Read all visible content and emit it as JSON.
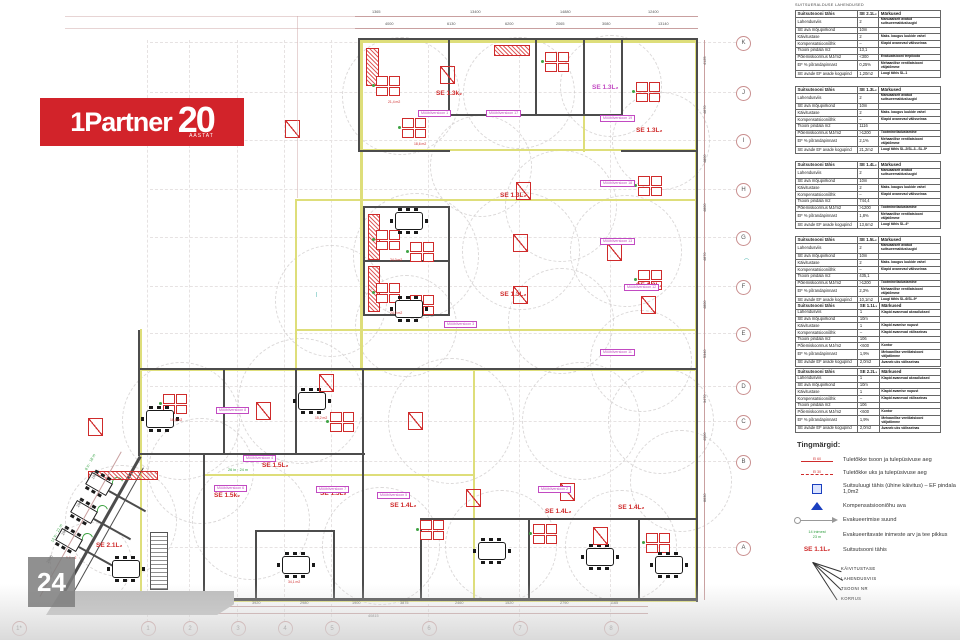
{
  "logo": {
    "brand": "1Partner",
    "twenty": "20",
    "sub": "AASTAT",
    "bg": "#d2232a"
  },
  "watermark": "24",
  "colors": {
    "accent_red": "#d2232a",
    "cad_red": "#cf2b2b",
    "magenta": "#c24ac2",
    "zone_yellow": "#dede7a",
    "wall": "#4c4c4c",
    "green": "#2e9e3e",
    "blue": "#1a3fbf"
  },
  "panel": {
    "title": "SUITSUERALDUSE LAHENDUSED",
    "row_labels": [
      "Suitsutsooni tähis",
      "Lahendusviis",
      "SE ava mõjupiirkond",
      "Käivitustase",
      "Kompensatsiooniõhk",
      "Tsooni pindala m2",
      "Põlemiskoormus MJ/m2",
      "EF % põrandapinnast",
      "SE avade EF avade kogupind"
    ],
    "remarks_header": "Märkused",
    "tables": [
      {
        "y": 10,
        "zone": "SE 2.1L₂",
        "values": [
          "2",
          "10m",
          "2",
          "–",
          "13,1",
          "<300",
          "0,25%",
          "1,20m2"
        ],
        "remarks": [
          "Manuaalselt avatud suitsueemaldusluugid",
          "",
          "Maks. kaugus luukide vahel",
          "Klapid avanevad välisseinas",
          "",
          "Evakuatsiooni trepikoda",
          "Mehaanilise ventilatsiooni väljatõmme",
          "Luugi tähis SL-1"
        ]
      },
      {
        "y": 86,
        "zone": "SE 1.3L₂",
        "values": [
          "2",
          "10m",
          "2",
          "–",
          "1116",
          ">1200",
          "2,1%",
          "21,2m2"
        ],
        "remarks": [
          "Manuaalselt avatud suitsueemaldusluugid",
          "",
          "Maks. kaugus luukide vahel",
          "Klapid avanevad välisseinas",
          "",
          "Tootmine/ladustamine",
          "Mehaanilise ventilatsiooni väljatõmme",
          "Luugi tähis SL-2/SL-3...SL-5*"
        ]
      },
      {
        "y": 161,
        "zone": "SE 1.4L₂",
        "values": [
          "2",
          "10m",
          "2",
          "–",
          "744,4",
          ">1200",
          "1,8%",
          "13,6m2"
        ],
        "remarks": [
          "Manuaalselt avatud suitsueemaldusluugid",
          "",
          "Maks. kaugus luukide vahel",
          "Klapid avanevad välisseinas",
          "",
          "Tootmine/ladustamine",
          "Mehaanilise ventilatsiooni väljatõmme",
          "Luugi tähis SL-4*"
        ]
      },
      {
        "y": 236,
        "zone": "SE 1.5L₂",
        "values": [
          "2",
          "10m",
          "2",
          "–",
          "435,1",
          ">1200",
          "2,3%",
          "10,1m2"
        ],
        "remarks": [
          "Manuaalselt avatud suitsueemaldusluugid",
          "",
          "Maks. kaugus luukide vahel",
          "Klapid avanevad välisseinas",
          "",
          "Tootmine/ladustamine",
          "Mehaanilise ventilatsiooni väljatõmme",
          "Luugi tähis SL-6/SL-9*"
        ]
      },
      {
        "y": 302,
        "zone": "SE 1.1L₁",
        "values": [
          "1",
          "10m",
          "1",
          "–",
          "106",
          "<600",
          "1,9%",
          "2,0m2"
        ],
        "remarks": [
          "Klapid avanevad aknad/uksed",
          "",
          "Klapid avamise nupust",
          "Klapid avanevad välisseinas",
          "",
          "Kontor",
          "Mehaanilise ventilatsiooni väljatõmme",
          "Avaneb uks välisseinas"
        ]
      },
      {
        "y": 368,
        "zone": "SE 2.2L₁",
        "values": [
          "1",
          "10m",
          "1",
          "–",
          "106",
          "<600",
          "1,9%",
          "2,0m2"
        ],
        "remarks": [
          "Klapid avanevad aknad/uksed",
          "",
          "Klapid avamise nupust",
          "Klapid avanevad välisseinas",
          "",
          "Kontor",
          "Mehaanilise ventilatsiooni väljatõmme",
          "Avaneb uks välisseinas"
        ]
      }
    ]
  },
  "legend": {
    "title": "Tingmärgid:",
    "items": [
      {
        "sym": "line-solid",
        "sym_text": "EI 60",
        "label": "Tuletõkke tsoon ja tulepüsivuse aeg"
      },
      {
        "sym": "line-dashed",
        "sym_text": "EI 30",
        "label": "Tuletõkke uks ja tulepüsivuse aeg"
      },
      {
        "sym": "blue-square",
        "label": "Suitsuluugi tähis (ühine käivitus) – EF pindala 1,0m2"
      },
      {
        "sym": "blue-triangle",
        "label": "Kompensatsiooniõhu ava"
      },
      {
        "sym": "arrow",
        "label": "Evakueerimise suund"
      },
      {
        "sym": "green-text",
        "sym_text": "14 inimest\n23 m",
        "label": "Evakueeritavate inimeste arv ja tee pikkus"
      },
      {
        "sym": "se-label",
        "sym_text": "SE 1.1L₂",
        "label": "Suitsutsooni tähis"
      }
    ],
    "callouts": [
      "KÄIVITUSTASE",
      "LAHENDUSVIIS",
      "TSOONI NR",
      "KORRUS"
    ]
  },
  "grid": {
    "bottom_bubbles": [
      [
        "1*",
        18
      ],
      [
        "1",
        147
      ],
      [
        "2",
        189
      ],
      [
        "3",
        237
      ],
      [
        "4",
        284
      ],
      [
        "5",
        331
      ],
      [
        "6",
        428
      ],
      [
        "7",
        519
      ],
      [
        "8",
        610
      ]
    ],
    "right_bubbles": [
      [
        "K",
        42
      ],
      [
        "J",
        92
      ],
      [
        "I",
        140
      ],
      [
        "H",
        189
      ],
      [
        "G",
        237
      ],
      [
        "F",
        286
      ],
      [
        "E",
        333
      ],
      [
        "D",
        386
      ],
      [
        "C",
        421
      ],
      [
        "B",
        461
      ],
      [
        "A",
        547
      ]
    ],
    "v_lines": [
      147,
      189,
      237,
      284,
      331,
      428,
      519,
      610
    ],
    "h_lines": [
      42,
      92,
      140,
      189,
      237,
      286,
      333,
      386,
      421,
      461,
      547
    ]
  },
  "plan": {
    "circles": [
      [
        400,
        95,
        58
      ],
      [
        518,
        92,
        55
      ],
      [
        610,
        85,
        50
      ],
      [
        660,
        140,
        48
      ],
      [
        415,
        255,
        62
      ],
      [
        520,
        250,
        58
      ],
      [
        625,
        250,
        55
      ],
      [
        405,
        325,
        50
      ],
      [
        560,
        320,
        52
      ],
      [
        480,
        165,
        50
      ],
      [
        560,
        205,
        55
      ],
      [
        330,
        300,
        55
      ],
      [
        300,
        400,
        62
      ],
      [
        180,
        420,
        58
      ],
      [
        450,
        420,
        62
      ],
      [
        580,
        420,
        58
      ],
      [
        660,
        420,
        52
      ],
      [
        250,
        520,
        58
      ],
      [
        380,
        545,
        58
      ],
      [
        500,
        545,
        55
      ],
      [
        620,
        545,
        55
      ],
      [
        120,
        520,
        55
      ],
      [
        90,
        562,
        40
      ],
      [
        680,
        480,
        50
      ],
      [
        640,
        360,
        50
      ],
      [
        200,
        470,
        52
      ]
    ],
    "zones": [
      [
        360,
        40,
        337,
        3
      ],
      [
        360,
        149,
        337,
        2
      ],
      [
        295,
        199,
        402,
        2
      ],
      [
        295,
        329,
        402,
        2
      ],
      [
        140,
        369,
        557,
        2
      ],
      [
        205,
        474,
        270,
        2
      ],
      [
        140,
        599,
        557,
        3
      ],
      [
        360,
        40,
        3,
        331
      ],
      [
        695,
        40,
        3,
        562
      ],
      [
        295,
        199,
        2,
        172
      ],
      [
        140,
        329,
        2,
        272
      ],
      [
        473,
        369,
        2,
        232
      ],
      [
        583,
        40,
        2,
        112
      ]
    ],
    "walls": [
      [
        358,
        38,
        340,
        2
      ],
      [
        358,
        38,
        2,
        114
      ],
      [
        448,
        38,
        2,
        78
      ],
      [
        535,
        38,
        2,
        78
      ],
      [
        583,
        38,
        2,
        78
      ],
      [
        621,
        38,
        2,
        78
      ],
      [
        448,
        114,
        175,
        2
      ],
      [
        358,
        150,
        92,
        2
      ],
      [
        621,
        150,
        77,
        2
      ],
      [
        696,
        38,
        2,
        564
      ],
      [
        363,
        206,
        87,
        2
      ],
      [
        363,
        206,
        2,
        110
      ],
      [
        448,
        206,
        2,
        110
      ],
      [
        363,
        260,
        87,
        2
      ],
      [
        363,
        314,
        87,
        2
      ],
      [
        138,
        368,
        560,
        2
      ],
      [
        362,
        370,
        2,
        230
      ],
      [
        138,
        330,
        2,
        126
      ],
      [
        138,
        453,
        227,
        2
      ],
      [
        223,
        368,
        2,
        87
      ],
      [
        295,
        368,
        2,
        87
      ],
      [
        203,
        454,
        2,
        146
      ],
      [
        60,
        598,
        638,
        3
      ],
      [
        255,
        530,
        80,
        2
      ],
      [
        255,
        530,
        2,
        70
      ],
      [
        333,
        530,
        2,
        70
      ],
      [
        420,
        518,
        110,
        2
      ],
      [
        420,
        518,
        2,
        82
      ],
      [
        528,
        518,
        2,
        82
      ],
      [
        530,
        518,
        110,
        2
      ],
      [
        638,
        518,
        60,
        2
      ],
      [
        638,
        518,
        2,
        82
      ]
    ],
    "diag_walls": [
      [
        60,
        598,
        164,
        3,
        -60.7
      ],
      [
        70,
        598,
        150,
        1,
        -60.7
      ]
    ],
    "diag_dividers": [
      [
        79,
        546,
        42,
        1.5,
        29
      ],
      [
        94,
        518,
        42,
        1.5,
        29
      ],
      [
        109,
        490,
        42,
        1.5,
        29
      ]
    ],
    "door_arcs": [
      [
        82,
        533,
        -60
      ],
      [
        97,
        505,
        -60
      ],
      [
        112,
        477,
        -60
      ]
    ],
    "hatches": [
      [
        366,
        48,
        11,
        36
      ],
      [
        494,
        45,
        34,
        9
      ],
      [
        368,
        214,
        10,
        44
      ],
      [
        368,
        266,
        10,
        44
      ],
      [
        88,
        471,
        68,
        7
      ]
    ],
    "stairs": [
      [
        150,
        532,
        16,
        56
      ]
    ],
    "quads": [
      [
        376,
        76
      ],
      [
        402,
        118
      ],
      [
        545,
        52
      ],
      [
        636,
        82
      ],
      [
        376,
        230
      ],
      [
        410,
        242
      ],
      [
        376,
        283
      ],
      [
        410,
        295
      ],
      [
        163,
        394
      ],
      [
        330,
        412
      ],
      [
        420,
        520
      ],
      [
        533,
        524
      ],
      [
        646,
        533
      ],
      [
        638,
        176
      ],
      [
        638,
        270
      ]
    ],
    "confs": [
      [
        395,
        212
      ],
      [
        395,
        300
      ],
      [
        146,
        410
      ],
      [
        298,
        392
      ],
      [
        282,
        556
      ],
      [
        478,
        542
      ],
      [
        586,
        548
      ],
      [
        112,
        560
      ],
      [
        655,
        556
      ]
    ],
    "sixes": [
      [
        62,
        528
      ],
      [
        77,
        500
      ],
      [
        92,
        472
      ]
    ],
    "efs": [
      [
        285,
        120
      ],
      [
        516,
        182
      ],
      [
        513,
        234
      ],
      [
        513,
        286
      ],
      [
        88,
        418
      ],
      [
        256,
        402
      ],
      [
        408,
        412
      ],
      [
        319,
        374
      ],
      [
        560,
        483
      ],
      [
        466,
        489
      ],
      [
        641,
        296
      ],
      [
        607,
        243
      ],
      [
        593,
        527
      ],
      [
        440,
        66
      ]
    ],
    "se_labels": [
      {
        "t": "SE 1.3k₂",
        "x": 436,
        "y": 90,
        "c": "red"
      },
      {
        "t": "SE 1.3L₂",
        "x": 592,
        "y": 84,
        "c": "mag"
      },
      {
        "t": "SE 1.3L₂",
        "x": 636,
        "y": 127,
        "c": "red"
      },
      {
        "t": "SE 1.3L₂",
        "x": 500,
        "y": 192,
        "c": "red"
      },
      {
        "t": "SE 1.3L₂",
        "x": 500,
        "y": 291,
        "c": "red"
      },
      {
        "t": "SE 1.3L₂",
        "x": 636,
        "y": 282,
        "c": "red"
      },
      {
        "t": "SE 1.5L₂",
        "x": 262,
        "y": 462,
        "c": "red"
      },
      {
        "t": "SE 1.5k₂",
        "x": 214,
        "y": 492,
        "c": "red"
      },
      {
        "t": "SE 1.5L₂",
        "x": 320,
        "y": 490,
        "c": "red"
      },
      {
        "t": "SE 1.4L₂",
        "x": 390,
        "y": 502,
        "c": "red"
      },
      {
        "t": "SE 1.4L₂",
        "x": 545,
        "y": 508,
        "c": "red"
      },
      {
        "t": "SE 1.4L₂",
        "x": 618,
        "y": 504,
        "c": "red"
      },
      {
        "t": "SE 2.1L₂",
        "x": 96,
        "y": 542,
        "c": "red"
      }
    ],
    "ver_labels": [
      {
        "t": "Mööbliversioon 1",
        "x": 418,
        "y": 110
      },
      {
        "t": "Mööbliversioon 17",
        "x": 486,
        "y": 110
      },
      {
        "t": "Mööbliversioon 19",
        "x": 600,
        "y": 115
      },
      {
        "t": "Mööbliversioon 18",
        "x": 600,
        "y": 180
      },
      {
        "t": "Mööbliversioon 13",
        "x": 600,
        "y": 238
      },
      {
        "t": "Mööbliversioon 12",
        "x": 624,
        "y": 284
      },
      {
        "t": "Mööbliversioon 11",
        "x": 600,
        "y": 349
      },
      {
        "t": "Mööbliversioon 3",
        "x": 444,
        "y": 321
      },
      {
        "t": "Mööbliversioon 8",
        "x": 216,
        "y": 407
      },
      {
        "t": "Mööbliversioon 4",
        "x": 243,
        "y": 455
      },
      {
        "t": "Mööbliversioon 6",
        "x": 214,
        "y": 485
      },
      {
        "t": "Mööbliversioon 7",
        "x": 316,
        "y": 486
      },
      {
        "t": "Mööbliversioon 5",
        "x": 377,
        "y": 492
      },
      {
        "t": "Mööbliversioon 2",
        "x": 538,
        "y": 486
      }
    ],
    "room_texts": [
      [
        388,
        100,
        "21,4 m2"
      ],
      [
        414,
        142,
        "18,6 m2"
      ],
      [
        390,
        258,
        "24,0 m2"
      ],
      [
        390,
        311,
        "24,0 m2"
      ],
      [
        170,
        418,
        "16,8 m2"
      ],
      [
        315,
        416,
        "15,2 m2"
      ],
      [
        288,
        580,
        "34,1 m2"
      ],
      [
        66,
        556,
        "9,6 m2"
      ]
    ],
    "green_texts": [
      [
        52,
        540,
        "12 in · 21 m",
        -61
      ],
      [
        86,
        468,
        "8 in · 18 m",
        -61
      ],
      [
        228,
        468,
        "26 in · 24 m",
        0
      ]
    ],
    "teal_marks": [
      [
        744,
        258,
        "⌒"
      ],
      [
        316,
        292,
        "|"
      ]
    ],
    "dim_lines": [
      [
        355,
        16,
        343,
        1,
        0
      ],
      [
        355,
        28,
        343,
        1,
        0
      ],
      [
        65,
        16,
        290,
        1,
        1
      ],
      [
        65,
        28,
        290,
        1,
        1
      ],
      [
        108,
        606,
        540,
        1,
        0
      ],
      [
        108,
        613,
        540,
        1,
        0
      ],
      [
        704,
        40,
        1,
        560,
        0
      ],
      [
        297,
        16,
        1,
        182,
        1
      ]
    ],
    "diag_dim_line": [
      40,
      596,
      166,
      1,
      -60.7
    ],
    "dim_texts_top1": [
      [
        372,
        "1365"
      ],
      [
        470,
        "13400"
      ],
      [
        560,
        "14880"
      ],
      [
        648,
        "12400"
      ]
    ],
    "dim_texts_top2": [
      [
        385,
        "4000"
      ],
      [
        447,
        "6130"
      ],
      [
        505,
        "6200"
      ],
      [
        556,
        "2065"
      ],
      [
        602,
        "3080"
      ],
      [
        658,
        "13140"
      ]
    ],
    "dim_texts_bottom": [
      [
        128,
        "1770"
      ],
      [
        162,
        "2940"
      ],
      [
        205,
        "7640"
      ],
      [
        252,
        "3920"
      ],
      [
        300,
        "2980"
      ],
      [
        352,
        "1900"
      ],
      [
        400,
        "3875"
      ],
      [
        455,
        "2460"
      ],
      [
        505,
        "1520"
      ],
      [
        560,
        "2790"
      ],
      [
        610,
        "1165"
      ]
    ],
    "dim_total_bottom": [
      368,
      "40815"
    ],
    "dim_texts_right": [
      [
        65,
        "4125"
      ],
      [
        114,
        "4870"
      ],
      [
        163,
        "4800"
      ],
      [
        212,
        "4800"
      ],
      [
        261,
        "4870"
      ],
      [
        309,
        "4800"
      ],
      [
        358,
        "5340"
      ],
      [
        403,
        "3470"
      ],
      [
        441,
        "4000"
      ],
      [
        502,
        "8630"
      ]
    ],
    "dim_texts_diag": [
      [
        46,
        562,
        "2905"
      ],
      [
        61,
        534,
        "2905"
      ],
      [
        76,
        506,
        "2905"
      ],
      [
        91,
        478,
        "1935"
      ]
    ]
  }
}
